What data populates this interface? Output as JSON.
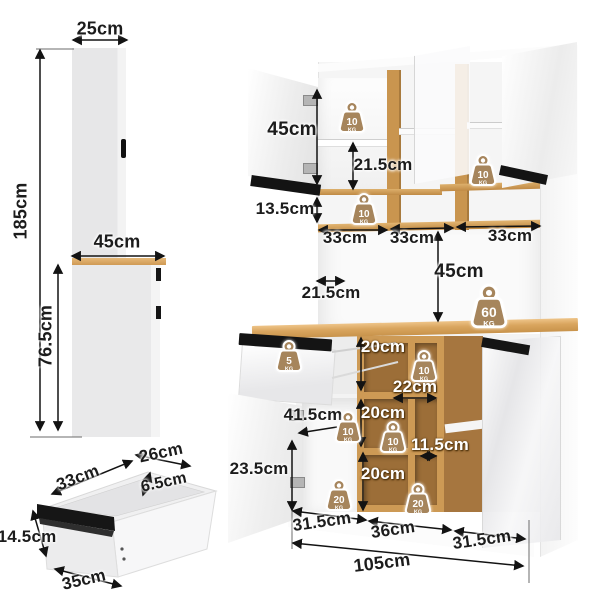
{
  "diagram": {
    "type": "furniture-dimension-diagram",
    "subject": "kitchen pantry cabinet with hutch",
    "unit": "cm"
  },
  "colors": {
    "wood": "#cd9a55",
    "wood_dark": "#a87a3d",
    "wood_interior": "#9c6e38",
    "badge_tan": "#a6855c",
    "handle_black": "#141414",
    "arrow": "#131313",
    "panel_gray": "#e9e9ea"
  },
  "labels": {
    "side_top_width": "25cm",
    "side_total_height": "185cm",
    "side_bottom_depth": "45cm",
    "side_bottom_height": "76.5cm",
    "drawer_length": "33cm",
    "drawer_depth": "26cm",
    "drawer_lip": "6.5cm",
    "drawer_front_height": "14.5cm",
    "drawer_width": "35cm",
    "hutch_door_height": "45cm",
    "hutch_shelf_gap": "21.5cm",
    "open_shelf_height": "13.5cm",
    "shelf_width_1": "33cm",
    "shelf_width_2": "33cm",
    "shelf_width_3": "33cm",
    "counter_clearance": "45cm",
    "counter_depth": "21.5cm",
    "cubby_height_1": "20cm",
    "cubby_width_top": "22cm",
    "cubby_height_2": "20cm",
    "cubby_width_mid": "11.5cm",
    "cubby_height_3": "20cm",
    "door_opening_width": "41.5cm",
    "door_opening_height": "23.5cm",
    "base_width_1": "31.5cm",
    "base_width_2": "36cm",
    "base_width_3": "31.5cm",
    "total_width": "105cm"
  },
  "badges": [
    {
      "value": "10",
      "unit": "KG"
    },
    {
      "value": "10",
      "unit": "KG"
    },
    {
      "value": "10",
      "unit": "KG"
    },
    {
      "value": "60",
      "unit": "KG"
    },
    {
      "value": "5",
      "unit": "KG"
    },
    {
      "value": "10",
      "unit": "KG"
    },
    {
      "value": "10",
      "unit": "KG"
    },
    {
      "value": "10",
      "unit": "KG"
    },
    {
      "value": "20",
      "unit": "KG"
    },
    {
      "value": "20",
      "unit": "KG"
    }
  ]
}
